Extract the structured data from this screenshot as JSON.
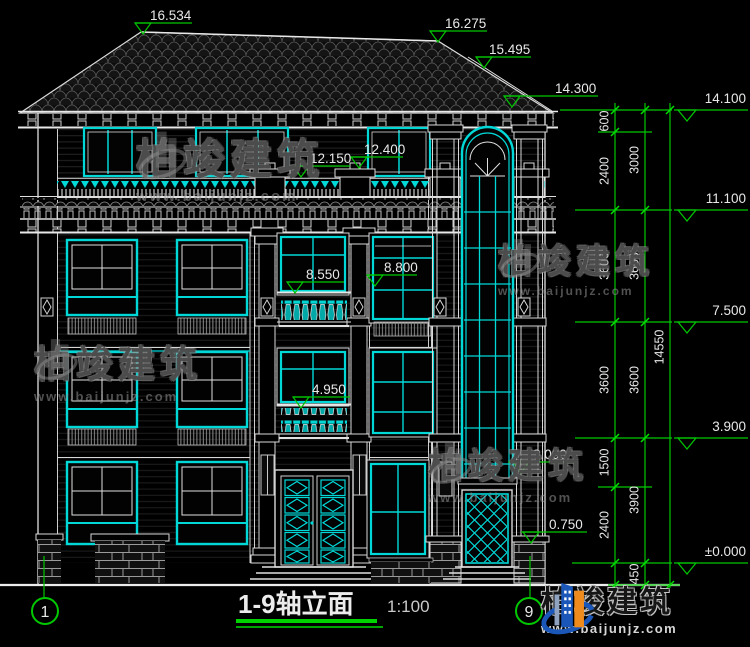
{
  "title_block": {
    "title": "1-9轴立面",
    "scale": "1:100"
  },
  "axis_bubbles": {
    "left": "1",
    "right": "9"
  },
  "watermark": {
    "brand": "柏竣建筑",
    "url": "www.baijunjz.com"
  },
  "elevations": {
    "ridge_main": "16.534",
    "ridge_right": "16.275",
    "roof_hip": "15.495",
    "tower_eave": "14.300",
    "attic_rail_mid": "12.150",
    "attic_rail_right": "12.400",
    "f3_rail_mid": "8.550",
    "f3_rail_right": "8.800",
    "f2_rail_mid": "4.950",
    "porch": "3.000",
    "sill": "0.750"
  },
  "levels": {
    "l1": "14.100",
    "l2": "11.100",
    "l3": "7.500",
    "l4": "3.900",
    "l5": "±0.000"
  },
  "chain_inner": [
    "600",
    "2400",
    "3600",
    "3600",
    "1500",
    "2400"
  ],
  "chain_mid": [
    "3000",
    "3600",
    "3600",
    "3900",
    "450"
  ],
  "chain_total": "14550",
  "colors": {
    "cad_line": "#e8e8e8",
    "cad_glass_cyan": "#00d8d8",
    "dimension_green": "#00c800",
    "logo_blue": "#1a57b8",
    "logo_orange": "#ef8b1d"
  }
}
